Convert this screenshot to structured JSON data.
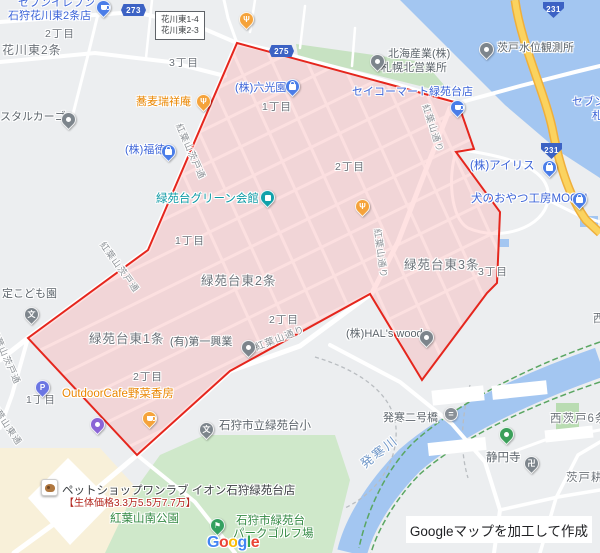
{
  "map": {
    "bg_color": "#eceef0",
    "highlight": {
      "fill": "rgba(255,140,140,0.25)",
      "stroke": "#e5261d",
      "points": "237,43 458,103 474,149 456,152 500,212 497,283 487,293 422,380 370,294 230,371 137,455 28,338 148,250"
    },
    "water_color": "#a3c6f1",
    "park_color": "#cfe8ca",
    "highway_color": "#fbd35f"
  },
  "landmark_box": {
    "lines": [
      "花川東1-4",
      "花川東2-3"
    ]
  },
  "road_badges": [
    {
      "t": "273",
      "k": "hex",
      "x": 121,
      "y": 4,
      "n": "route-273-badge"
    },
    {
      "t": "275",
      "k": "hex",
      "x": 269,
      "y": 45,
      "n": "route-275-badge"
    },
    {
      "t": "231",
      "k": "shield",
      "x": 543,
      "y": 2,
      "n": "route-231-badge-north"
    },
    {
      "t": "231",
      "k": "shield",
      "x": 541,
      "y": 143,
      "n": "route-231-badge-south"
    }
  ],
  "labels": [
    {
      "t": "セブンイレブン",
      "s": "blue",
      "x": 18,
      "y": -3,
      "n": "seven-eleven-label"
    },
    {
      "t": "石狩花川東2条店",
      "s": "blue",
      "x": 8,
      "y": 10,
      "n": "seven-eleven-label-2"
    },
    {
      "t": "花川東2条",
      "s": "area",
      "x": 2,
      "y": 44,
      "fs": 12,
      "n": "area-hanakawahigashi-2jo"
    },
    {
      "t": "2丁目",
      "s": "area",
      "x": 45,
      "y": 28,
      "fs": 10.5
    },
    {
      "t": "3丁目",
      "s": "area",
      "x": 169,
      "y": 57,
      "fs": 10.5
    },
    {
      "t": "蕎麦瑞祥庵",
      "s": "orange",
      "x": 136,
      "y": 96,
      "n": "soba-zuishoan-label"
    },
    {
      "t": "(株)六光園",
      "s": "blue",
      "x": 235,
      "y": 82,
      "n": "rokkoen-label"
    },
    {
      "t": "セイコーマート緑苑台店",
      "s": "blue",
      "x": 352,
      "y": 86,
      "n": "seicomart-label"
    },
    {
      "t": "北海産業(株)",
      "s": "biz",
      "x": 388,
      "y": 48,
      "n": "hokkai-sangyo-label"
    },
    {
      "t": "札幌北営業所",
      "s": "biz",
      "x": 381,
      "y": 62,
      "n": "hokkai-sangyo-label-2"
    },
    {
      "t": "茨戸水位観測所",
      "s": "biz",
      "x": 497,
      "y": 42,
      "n": "water-station-label"
    },
    {
      "t": "セブン",
      "s": "blue",
      "x": 572,
      "y": 96,
      "n": "edge-seven-label"
    },
    {
      "t": "札",
      "s": "blue",
      "x": 592,
      "y": 110,
      "n": "edge-sapporo-label"
    },
    {
      "t": "スタルカーゴ",
      "s": "biz",
      "x": 0,
      "y": 111,
      "n": "rental-cargo-label"
    },
    {
      "t": "(株)福徳",
      "s": "blue",
      "x": 125,
      "y": 144,
      "n": "fukutoku-label"
    },
    {
      "t": "1丁目",
      "s": "area",
      "x": 262,
      "y": 101,
      "fs": 10.5
    },
    {
      "t": "(株)アイリス",
      "s": "blue",
      "x": 470,
      "y": 160,
      "fs": 11.5,
      "n": "iris-label"
    },
    {
      "t": "犬のおやつ工房MOGU",
      "s": "blue",
      "x": 471,
      "y": 193,
      "fs": 11.5,
      "n": "mogu-label"
    },
    {
      "t": "緑苑台グリーン会館",
      "s": "teal",
      "x": 156,
      "y": 193,
      "fs": 11.5,
      "n": "green-hall-label"
    },
    {
      "t": "2丁目",
      "s": "area",
      "x": 335,
      "y": 161,
      "fs": 10.5
    },
    {
      "t": "1丁目",
      "s": "area",
      "x": 175,
      "y": 235,
      "fs": 10.5
    },
    {
      "t": "緑苑台東2条",
      "s": "area",
      "x": 201,
      "y": 274,
      "fs": 12.5,
      "n": "area-ryokuendai-higashi-2jo"
    },
    {
      "t": "緑苑台東3条",
      "s": "area",
      "x": 404,
      "y": 258,
      "fs": 12.5,
      "n": "area-ryokuendai-higashi-3jo"
    },
    {
      "t": "3丁目",
      "s": "area",
      "x": 478,
      "y": 266,
      "fs": 10.5
    },
    {
      "t": "2丁目",
      "s": "area",
      "x": 269,
      "y": 314,
      "fs": 10.5
    },
    {
      "t": "緑苑台東1条",
      "s": "area",
      "x": 89,
      "y": 332,
      "fs": 12.5,
      "n": "area-ryokuendai-higashi-1jo"
    },
    {
      "t": "(有)第一興業",
      "s": "biz",
      "x": 170,
      "y": 336,
      "n": "daiichi-kogyo-label"
    },
    {
      "t": "(株)HAL's wood",
      "s": "biz",
      "x": 346,
      "y": 328,
      "n": "hals-wood-label"
    },
    {
      "t": "2丁目",
      "s": "area",
      "x": 133,
      "y": 371,
      "fs": 10.5
    },
    {
      "t": "1丁目",
      "s": "area",
      "x": 26,
      "y": 394,
      "fs": 10.5
    },
    {
      "t": "OutdoorCafe野菜香房",
      "s": "orange",
      "x": 62,
      "y": 388,
      "fs": 11.5,
      "n": "outdoor-cafe-label"
    },
    {
      "t": "定こども園",
      "s": "biz",
      "x": 2,
      "y": 288,
      "n": "kodomoen-label"
    },
    {
      "t": "石狩市立緑苑台小",
      "s": "biz",
      "x": 219,
      "y": 420,
      "fs": 11.5,
      "n": "elementary-school-label"
    },
    {
      "t": "発寒二号橋",
      "s": "biz",
      "x": 383,
      "y": 412,
      "n": "bridge-label"
    },
    {
      "t": "西茨戸6条",
      "s": "area",
      "x": 550,
      "y": 413,
      "fs": 11.5,
      "n": "area-nishibarato-6jo"
    },
    {
      "t": "静円寺",
      "s": "biz",
      "x": 486,
      "y": 452,
      "fs": 11.5,
      "n": "joenji-temple-label"
    },
    {
      "t": "茨戸耕",
      "s": "area",
      "x": 566,
      "y": 472,
      "fs": 11.5,
      "n": "area-barato-edge"
    },
    {
      "t": "西",
      "s": "area",
      "x": 593,
      "y": 313,
      "fs": 11.5
    },
    {
      "t": "ペットショップワンラブ イオン石狩緑苑台店",
      "s": "dark",
      "x": 62,
      "y": 485,
      "fs": 11.5,
      "n": "petshop-label"
    },
    {
      "t": "【生体価格3.3万5.5万7.7万】",
      "s": "red",
      "x": 64,
      "y": 498,
      "fs": 10,
      "n": "petshop-price-label"
    },
    {
      "t": "紅葉山南公園",
      "s": "green",
      "x": 110,
      "y": 513,
      "fs": 11.5,
      "n": "momijiyama-park-label"
    },
    {
      "t": "石狩市緑苑台",
      "s": "green",
      "x": 236,
      "y": 515,
      "fs": 11.5,
      "n": "park-golf-label"
    },
    {
      "t": "パークゴルフ場",
      "s": "green",
      "x": 233,
      "y": 528,
      "fs": 11.5,
      "n": "park-golf-label-2"
    },
    {
      "t": "発寒川",
      "s": "water",
      "x": 358,
      "y": 460,
      "fs": 12.5,
      "r": -38,
      "n": "hassamu-river-label"
    },
    {
      "t": "紅葉山茨戸通",
      "s": "road",
      "x": 183,
      "y": 122,
      "fs": 9,
      "r": 66
    },
    {
      "t": "紅葉山茨戸通",
      "s": "road",
      "x": 106,
      "y": 240,
      "fs": 9,
      "r": 54
    },
    {
      "t": "紅葉山茨戸通",
      "s": "road",
      "x": -2,
      "y": 327,
      "fs": 9,
      "r": 66
    },
    {
      "t": "紅葉山東通",
      "s": "road",
      "x": -4,
      "y": 400,
      "fs": 9,
      "r": 56
    },
    {
      "t": "紅葉山通り",
      "s": "road",
      "x": 430,
      "y": 103,
      "fs": 9,
      "r": 72
    },
    {
      "t": "紅葉山通り",
      "s": "road",
      "x": 382,
      "y": 228,
      "fs": 9,
      "r": 82
    },
    {
      "t": "紅葉山通り",
      "s": "road",
      "x": 254,
      "y": 344,
      "fs": 9.5,
      "r": -21
    }
  ],
  "pins": [
    {
      "n": "seven-eleven-pin",
      "c": "#4a7de8",
      "g": "cup",
      "x": 103,
      "y": 18
    },
    {
      "n": "restaurant-pin-north",
      "c": "#f5a33b",
      "g": "fork",
      "x": 246,
      "y": 30
    },
    {
      "n": "soba-restaurant-pin",
      "c": "#f5a33b",
      "g": "fork",
      "x": 203,
      "y": 112
    },
    {
      "n": "hokkai-sangyo-pin",
      "c": "#7d858c",
      "g": "dot",
      "x": 377,
      "y": 72
    },
    {
      "n": "water-station-pin",
      "c": "#7d858c",
      "g": "dot",
      "x": 486,
      "y": 60
    },
    {
      "n": "seicomart-pin",
      "c": "#4a7de8",
      "g": "cup",
      "x": 457,
      "y": 118
    },
    {
      "n": "rokkoen-pin",
      "c": "#4a7de8",
      "g": "bag",
      "x": 292,
      "y": 97
    },
    {
      "n": "rental-cargo-pin",
      "c": "#7d858c",
      "g": "dot",
      "x": 68,
      "y": 130
    },
    {
      "n": "fukutoku-pin",
      "c": "#4a7de8",
      "g": "bag",
      "x": 168,
      "y": 162
    },
    {
      "n": "green-hall-pin",
      "c": "#12a1aa",
      "g": "bld",
      "x": 267,
      "y": 208
    },
    {
      "n": "restaurant-pin-center",
      "c": "#f5a33b",
      "g": "fork",
      "x": 362,
      "y": 217
    },
    {
      "n": "iris-pin",
      "c": "#4a7de8",
      "g": "bag",
      "x": 549,
      "y": 178
    },
    {
      "n": "mogu-pin",
      "c": "#4a7de8",
      "g": "bag",
      "x": 579,
      "y": 210
    },
    {
      "n": "kodomoen-school-pin",
      "c": "#7d858c",
      "g": "char:文",
      "x": 31,
      "y": 325
    },
    {
      "n": "parking-pin",
      "c": "#6b76e3",
      "g": "char:P",
      "x": 42,
      "y": 398
    },
    {
      "n": "outdoor-cafe-pin",
      "c": "#f5a33b",
      "g": "cup",
      "x": 149,
      "y": 429
    },
    {
      "n": "landmark-pin",
      "c": "#8a64d6",
      "g": "dot",
      "x": 97,
      "y": 435
    },
    {
      "n": "daiichi-kogyo-pin",
      "c": "#7d858c",
      "g": "dot",
      "x": 248,
      "y": 358
    },
    {
      "n": "hals-wood-pin",
      "c": "#7d858c",
      "g": "dot",
      "x": 426,
      "y": 348
    },
    {
      "n": "elementary-school-pin",
      "c": "#7d858c",
      "g": "char:文",
      "x": 206,
      "y": 440
    },
    {
      "n": "bridge-icon",
      "c": "#8a9097",
      "g": "char:=",
      "x": 451,
      "y": 421,
      "k": "circle"
    },
    {
      "n": "temple-statue-pin",
      "c": "#3ba05a",
      "g": "dot",
      "x": 506,
      "y": 445
    },
    {
      "n": "manji-temple-pin",
      "c": "#7d858c",
      "g": "char:卍",
      "x": 531,
      "y": 474
    },
    {
      "n": "golf-pin",
      "c": "#34a060",
      "g": "char:⚑",
      "x": 217,
      "y": 536
    },
    {
      "n": "petshop-photo-icon",
      "g": "dog",
      "x": 49,
      "y": 495,
      "k": "photo"
    }
  ],
  "attribution": {
    "notice": "Googleマップを加工して作成",
    "logo_letters": [
      {
        "ch": "G",
        "c": "#4285F4"
      },
      {
        "ch": "o",
        "c": "#EA4335"
      },
      {
        "ch": "o",
        "c": "#FBBC04"
      },
      {
        "ch": "g",
        "c": "#4285F4"
      },
      {
        "ch": "l",
        "c": "#34A853"
      },
      {
        "ch": "e",
        "c": "#EA4335"
      }
    ]
  }
}
